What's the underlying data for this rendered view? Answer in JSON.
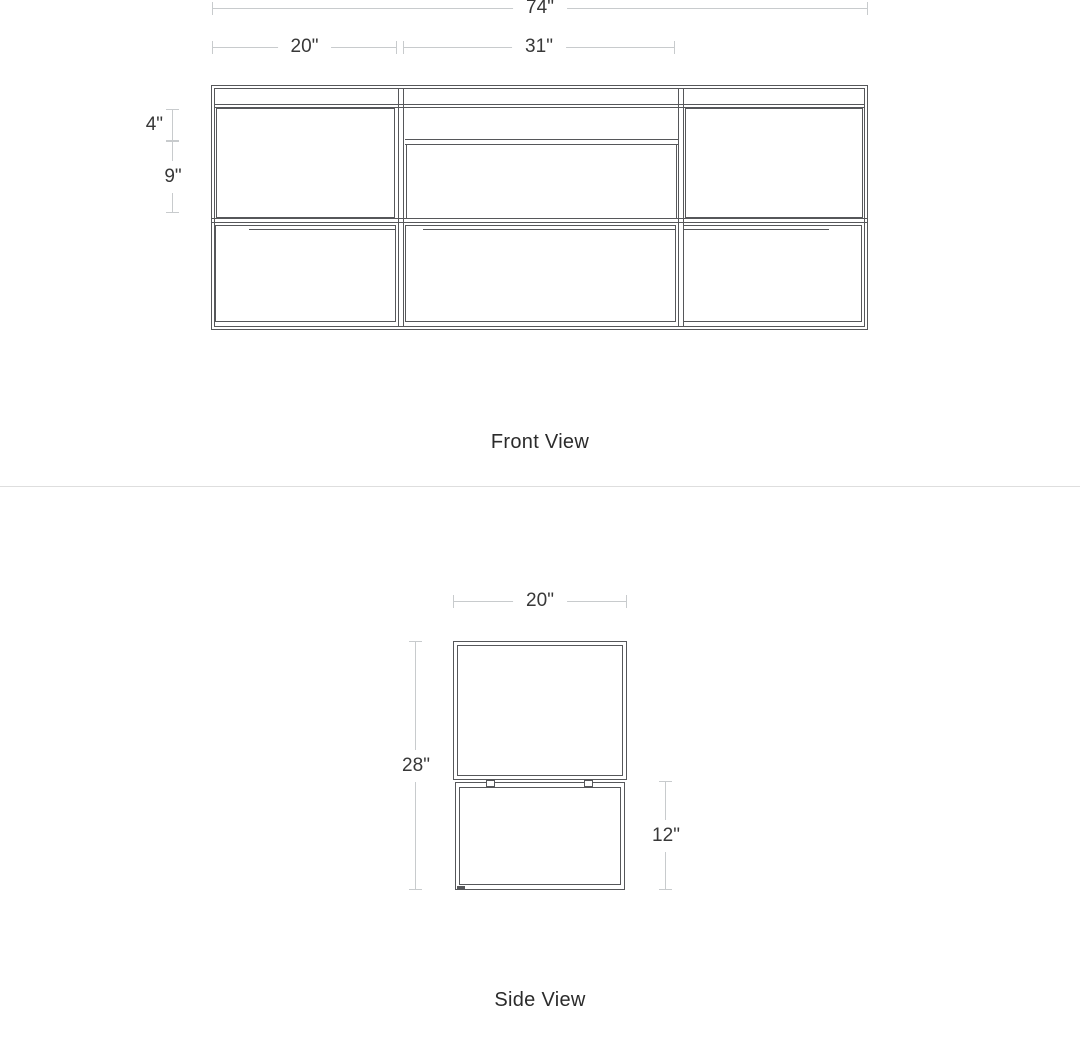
{
  "front": {
    "title": "Front View",
    "dim_total_width": "74\"",
    "dim_left_width": "20\"",
    "dim_center_width": "31\"",
    "dim_shelf_height": "4\"",
    "dim_compartment_height": "9\""
  },
  "side": {
    "title": "Side View",
    "dim_width": "20\"",
    "dim_total_height": "28\"",
    "dim_base_height": "12\""
  },
  "colors": {
    "drawing_line": "#56575a",
    "dimension_line": "#c8cbcd",
    "text": "#383838",
    "section_divider": "#dedede",
    "background": "#ffffff"
  }
}
